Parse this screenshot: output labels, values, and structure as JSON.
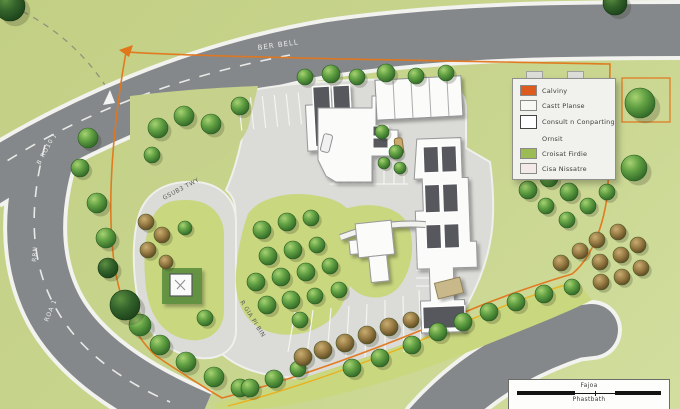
{
  "colors": {
    "field": "#c6d28b",
    "road": "#85888b",
    "road_edge": "#f2f2ef",
    "pavement": "#dbdbd7",
    "island": "#c9d77f",
    "roof": "#56595d",
    "building": "#fbfbf9",
    "boundary": "#e2761b",
    "boundary2": "#eab11f",
    "kiosk_pad": "#5c8f3f"
  },
  "road_labels": {
    "main_road": "BER BELL",
    "west_road_upper": "B RO10 J",
    "west_road_mid": "RRN",
    "west_road_lower": "ROA 1",
    "inner_loop": "GSUB3 TWY",
    "inner_south": "R GIA PI BIN"
  },
  "legend": {
    "items": [
      {
        "swatch": "#dd5b1f",
        "label": "Calviny"
      },
      {
        "swatch": "#f7f7f3",
        "label": "Castt Planse"
      },
      {
        "swatch": "outline",
        "label": "Consult n Conparting"
      },
      {
        "swatch": "none",
        "label": "Ornsit"
      },
      {
        "swatch": "#9cbb55",
        "label": "Croisat Firdie"
      },
      {
        "swatch": "#f3e9e6",
        "label": "Cisa Nissatre"
      }
    ]
  },
  "scalebar": {
    "top_label": "Fajoa",
    "bottom_label": "Phastbath"
  },
  "map": {
    "trees_green": [
      [
        88,
        138,
        10
      ],
      [
        80,
        168,
        9
      ],
      [
        97,
        203,
        10
      ],
      [
        106,
        238,
        10
      ],
      [
        140,
        325,
        11
      ],
      [
        160,
        345,
        10
      ],
      [
        186,
        362,
        10
      ],
      [
        214,
        377,
        10
      ],
      [
        240,
        388,
        9
      ],
      [
        158,
        128,
        10
      ],
      [
        184,
        116,
        10
      ],
      [
        211,
        124,
        10
      ],
      [
        240,
        106,
        9
      ],
      [
        152,
        155,
        8
      ],
      [
        305,
        77,
        8
      ],
      [
        331,
        74,
        9
      ],
      [
        357,
        77,
        8
      ],
      [
        386,
        73,
        9
      ],
      [
        416,
        76,
        8
      ],
      [
        446,
        73,
        8
      ],
      [
        382,
        132,
        7
      ],
      [
        396,
        152,
        7
      ],
      [
        384,
        163,
        6
      ],
      [
        400,
        168,
        6
      ],
      [
        262,
        230,
        9
      ],
      [
        287,
        222,
        9
      ],
      [
        311,
        218,
        8
      ],
      [
        268,
        256,
        9
      ],
      [
        293,
        250,
        9
      ],
      [
        317,
        245,
        8
      ],
      [
        256,
        282,
        9
      ],
      [
        281,
        277,
        9
      ],
      [
        306,
        272,
        9
      ],
      [
        330,
        266,
        8
      ],
      [
        267,
        305,
        9
      ],
      [
        291,
        300,
        9
      ],
      [
        315,
        296,
        8
      ],
      [
        339,
        290,
        8
      ],
      [
        300,
        320,
        8
      ],
      [
        205,
        318,
        8
      ],
      [
        185,
        228,
        7
      ],
      [
        250,
        388,
        9
      ],
      [
        274,
        379,
        9
      ],
      [
        298,
        369,
        8
      ],
      [
        352,
        368,
        9
      ],
      [
        380,
        358,
        9
      ],
      [
        412,
        345,
        9
      ],
      [
        438,
        332,
        9
      ],
      [
        463,
        322,
        9
      ],
      [
        489,
        312,
        9
      ],
      [
        516,
        302,
        9
      ],
      [
        544,
        294,
        9
      ],
      [
        572,
        287,
        8
      ],
      [
        640,
        103,
        15
      ],
      [
        634,
        168,
        13
      ],
      [
        600,
        142,
        9
      ],
      [
        528,
        190,
        9
      ],
      [
        549,
        178,
        9
      ],
      [
        569,
        192,
        9
      ],
      [
        546,
        206,
        8
      ],
      [
        567,
        220,
        8
      ],
      [
        588,
        206,
        8
      ],
      [
        607,
        192,
        8
      ]
    ],
    "trees_dark": [
      [
        10,
        6,
        15
      ],
      [
        125,
        305,
        15
      ],
      [
        108,
        268,
        10
      ],
      [
        615,
        3,
        12
      ]
    ],
    "shrubs": [
      [
        146,
        222,
        8
      ],
      [
        162,
        235,
        8
      ],
      [
        148,
        250,
        8
      ],
      [
        166,
        262,
        7
      ],
      [
        303,
        357,
        9
      ],
      [
        323,
        350,
        9
      ],
      [
        345,
        343,
        9
      ],
      [
        367,
        335,
        9
      ],
      [
        389,
        327,
        9
      ],
      [
        411,
        320,
        8
      ],
      [
        597,
        240,
        8
      ],
      [
        618,
        232,
        8
      ],
      [
        638,
        245,
        8
      ],
      [
        600,
        262,
        8
      ],
      [
        621,
        255,
        8
      ],
      [
        641,
        268,
        8
      ],
      [
        580,
        251,
        8
      ],
      [
        561,
        263,
        8
      ],
      [
        601,
        282,
        8
      ],
      [
        622,
        277,
        8
      ]
    ]
  }
}
